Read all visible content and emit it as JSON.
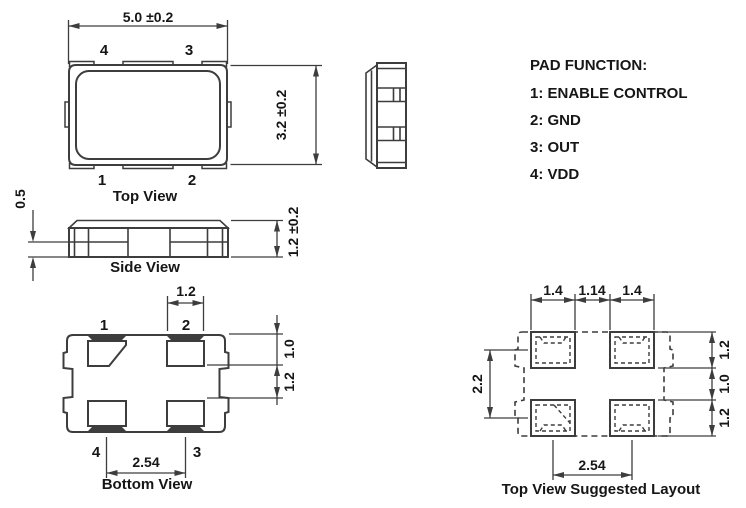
{
  "pad_function": {
    "title": "PAD FUNCTION:",
    "items": [
      "1: ENABLE CONTROL",
      "2: GND",
      "3: OUT",
      "4: VDD"
    ]
  },
  "top_view": {
    "title": "Top View",
    "width_dim": "5.0 ±0.2",
    "height_dim": "3.2 ±0.2",
    "pin_top_left": "4",
    "pin_top_right": "3",
    "pin_bottom_left": "1",
    "pin_bottom_right": "2"
  },
  "side_view": {
    "title": "Side View",
    "pad_thickness_dim": "0.5",
    "height_dim": "1.2 ±0.2"
  },
  "bottom_view": {
    "title": "Bottom View",
    "pad_width_dim": "1.2",
    "pad_height_dim": "1.0",
    "pad_row_gap_dim": "1.2",
    "pad_pitch_dim": "2.54",
    "pin_top_left": "1",
    "pin_top_right": "2",
    "pin_bottom_left": "4",
    "pin_bottom_right": "3"
  },
  "layout_view": {
    "title": "Top View Suggested Layout",
    "pad_width_left_dim": "1.4",
    "pad_gap_dim": "1.14",
    "pad_width_right_dim": "1.4",
    "row_pitch_dim": "2.2",
    "pad_height_top_dim": "1.2",
    "row_gap_dim": "1.0",
    "pad_height_bottom_dim": "1.2",
    "pad_pitch_dim": "2.54"
  },
  "colors": {
    "line": "#3d3d3d",
    "text": "#161616",
    "background": "#ffffff"
  }
}
